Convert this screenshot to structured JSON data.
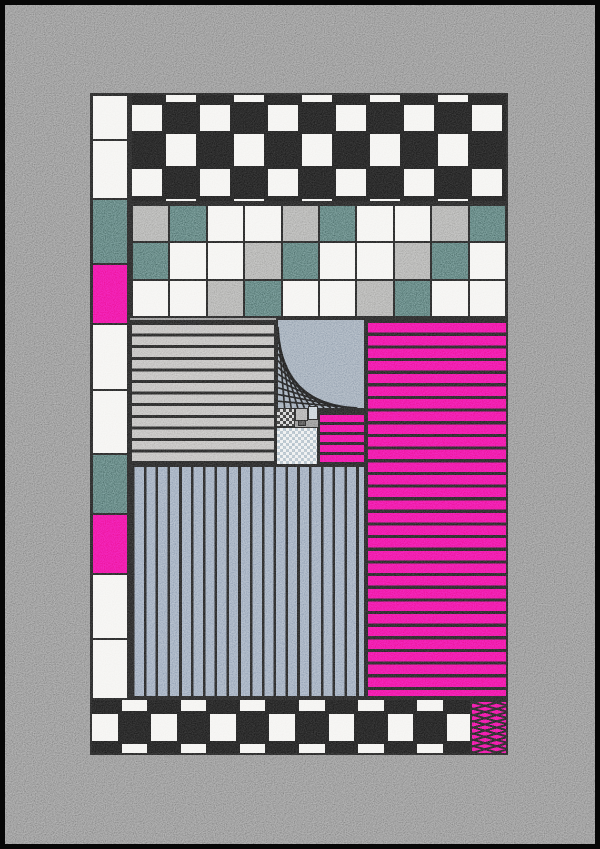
{
  "artwork": {
    "kind": "abstract-quilt-composition",
    "background_color": "#7b7b7b",
    "frame_color": "#070707",
    "line_color": "#181818",
    "palette": {
      "white": "#f1f0ed",
      "black": "#141414",
      "teal": "#42615e",
      "pink": "#ea0d8c",
      "gray": "#9c9c9a",
      "light_gray": "#aeacaa",
      "blue_gray": "#8694a4",
      "steel_blue": "#8595ab",
      "pale_blue": "#bac6cf"
    },
    "blocks": [
      {
        "name": "left-column",
        "type": "grid",
        "x": 90,
        "y": 93,
        "w": 40,
        "h": 607,
        "rowHeights": [
          45,
          59,
          65,
          60,
          66,
          64,
          60,
          60,
          65,
          63
        ],
        "cells": [
          [
            "white"
          ],
          [
            "white"
          ],
          [
            "teal"
          ],
          [
            "pink"
          ],
          [
            "white"
          ],
          [
            "white"
          ],
          [
            "teal"
          ],
          [
            "pink"
          ],
          [
            "white"
          ],
          [
            "white"
          ]
        ]
      },
      {
        "name": "top-checkerboard",
        "type": "checkerboard",
        "x": 130,
        "y": 93,
        "w": 378,
        "h": 110,
        "rowHeights": [
          10,
          29,
          35,
          30,
          6
        ],
        "cols": 11,
        "bg": "black",
        "cell": "white",
        "parity": 1
      },
      {
        "name": "color-grid",
        "type": "grid",
        "x": 130,
        "y": 203,
        "w": 378,
        "h": 115,
        "rowHeights": [
          37,
          38,
          40
        ],
        "cells": [
          [
            "gray",
            "teal",
            "white",
            "white",
            "gray",
            "teal",
            "white",
            "white",
            "gray",
            "teal"
          ],
          [
            "teal",
            "white",
            "white",
            "gray",
            "teal",
            "white",
            "white",
            "gray",
            "teal",
            "white"
          ],
          [
            "white",
            "white",
            "gray",
            "teal",
            "white",
            "white",
            "gray",
            "teal",
            "white",
            "white"
          ]
        ]
      },
      {
        "name": "gray-stripes-panel",
        "type": "hstripes",
        "x": 130,
        "y": 320,
        "w": 146,
        "h": 145,
        "color": "light_gray",
        "line": 3,
        "pitch": 11.6
      },
      {
        "name": "curve-panel",
        "type": "curve",
        "x": 276,
        "y": 318,
        "w": 90,
        "h": 92,
        "color": "blue_gray",
        "lines": 13
      },
      {
        "name": "dither-dark-chip",
        "type": "dither",
        "x": 276,
        "y": 408,
        "w": 19,
        "h": 19,
        "c1": "#c9c9c9",
        "c2": "#262626",
        "size": 6,
        "border": 1
      },
      {
        "name": "gray-chip",
        "type": "solid",
        "x": 295,
        "y": 408,
        "w": 13,
        "h": 13,
        "color": "#9b9b9b",
        "border": 1
      },
      {
        "name": "pale-blue-chip",
        "type": "solid",
        "x": 308,
        "y": 406,
        "w": 10,
        "h": 14,
        "color": "pale_blue",
        "border": 1
      },
      {
        "name": "dark-chip",
        "type": "solid",
        "x": 298,
        "y": 420,
        "w": 8,
        "h": 6,
        "color": "#3b3b3b",
        "border": 1
      },
      {
        "name": "dither-light-panel",
        "type": "dither",
        "x": 276,
        "y": 427,
        "w": 42,
        "h": 38,
        "c1": "#e9ebec",
        "c2": "#9fb0bc",
        "size": 6,
        "border": 1.5
      },
      {
        "name": "small-pink-stripes",
        "type": "hstripes",
        "x": 318,
        "y": 410,
        "w": 48,
        "h": 55,
        "color": "pink",
        "line": 3,
        "pitch": 10
      },
      {
        "name": "pink-stripes-panel",
        "type": "hstripes",
        "x": 366,
        "y": 318,
        "w": 142,
        "h": 380,
        "color": "pink",
        "line": 3.2,
        "pitch": 12.65
      },
      {
        "name": "vertical-stripes-panel",
        "type": "vstripes",
        "x": 130,
        "y": 465,
        "w": 236,
        "h": 233,
        "color": "steel_blue",
        "line": 2.6,
        "pitch": 11.8
      },
      {
        "name": "bottom-checkerboard",
        "type": "checkerboard",
        "x": 90,
        "y": 698,
        "w": 418,
        "h": 57,
        "rowHeights": [
          14,
          30,
          13
        ],
        "cols": 14,
        "bg": "black",
        "cell": "white",
        "parity": 1
      },
      {
        "name": "crosshatch-panel",
        "type": "crosshatch",
        "x": 470,
        "y": 700,
        "w": 38,
        "h": 55,
        "color": "pink"
      }
    ]
  }
}
